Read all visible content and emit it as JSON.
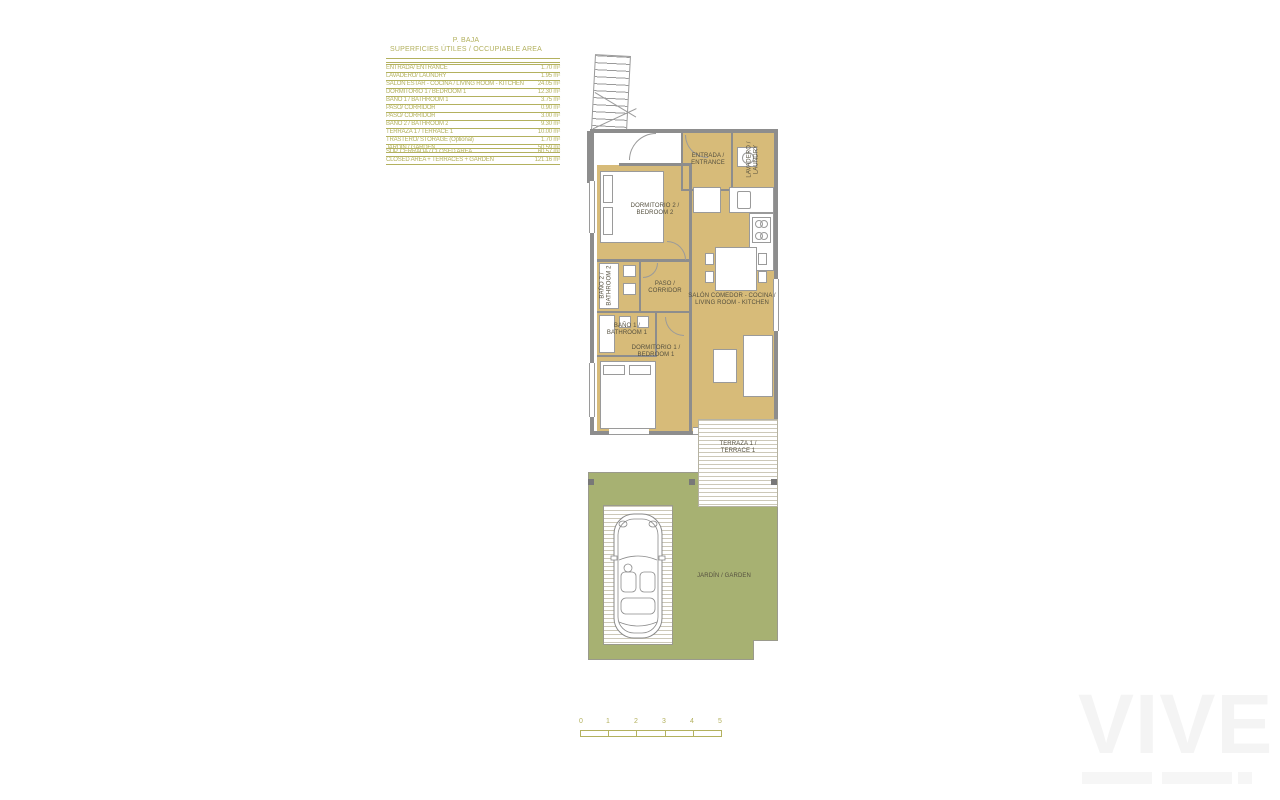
{
  "title": {
    "line1": "P. BAJA",
    "line2": "SUPERFICIES ÚTILES / OCCUPIABLE AREA"
  },
  "area_table": {
    "rows": [
      {
        "label": "ENTRADA/ ENTRANCE",
        "value": "1.70 m²"
      },
      {
        "label": "LAVADERO/ LAUNDRY",
        "value": "1.95 m²"
      },
      {
        "label": "SALÓN ESTAR - COCINA / LIVING ROOM - KITCHEN",
        "value": "24.05 m²"
      },
      {
        "label": "DORMITORIO 1 /  BEDROOM 1",
        "value": "12.30 m²"
      },
      {
        "label": "BAÑO 1 / BATHROOM 1",
        "value": "3.75 m²"
      },
      {
        "label": "PASO/ CORRIDOR",
        "value": "0.90 m²"
      },
      {
        "label": "PASO/ CORRIDOR",
        "value": "3.00 m²"
      },
      {
        "label": "BAÑO 2 / BATHROOM 2",
        "value": "9.30 m²"
      },
      {
        "label": "TERRAZA 1 / TERRACE 1",
        "value": "10.00 m²"
      },
      {
        "label": "TRASTERO/ STORAGE (Optional)",
        "value": "1.70 m²"
      },
      {
        "label": "JARDÍN / GARDEN",
        "value": "50.59 m²"
      }
    ],
    "summary": [
      {
        "label": "SUP. CERRADA / CLOSED AREA",
        "value": "60.57 m²"
      },
      {
        "label": "CLOSED AREA + TERRACES + GARDEN",
        "value": "121.16 m²"
      }
    ]
  },
  "plan": {
    "labels": {
      "trastero": {
        "l1": "TRASTERO /",
        "l2": "STORAGE"
      },
      "entrada": {
        "l1": "ENTRADA /",
        "l2": "ENTRANCE"
      },
      "lavadero": {
        "l1": "LAVADERO /",
        "l2": "LAUNDRY"
      },
      "dorm2": {
        "l1": "DORMITORIO 2 /",
        "l2": "BEDROOM 2"
      },
      "bano2": {
        "l1": "BAÑO 2 /",
        "l2": "BATHROOM 2"
      },
      "paso": {
        "l1": "PASO /",
        "l2": "CORRIDOR"
      },
      "salon": {
        "l1": "SALÓN COMEDOR - COCINA /",
        "l2": "LIVING ROOM - KITCHEN"
      },
      "bano1": {
        "l1": "BAÑO 1 /",
        "l2": "BATHROOM 1"
      },
      "dorm1": {
        "l1": "DORMITORIO 1 /",
        "l2": "BEDROOM 1"
      },
      "terraza": {
        "l1": "TERRAZA 1 /",
        "l2": "TERRACE 1"
      },
      "jardin": {
        "text": "JARDÍN / GARDEN"
      }
    }
  },
  "scale_bar": {
    "ticks": [
      "0",
      "1",
      "2",
      "3",
      "4",
      "5"
    ]
  },
  "watermark": {
    "text": "VIVE"
  },
  "palette": {
    "accent_olive": "#b3b15e",
    "room_fill": "#d7bb79",
    "wall_gray": "#8d8d8d",
    "garden_green": "#a7b172",
    "label_text": "#55503f",
    "watermark_gray": "#f4f4f4"
  }
}
